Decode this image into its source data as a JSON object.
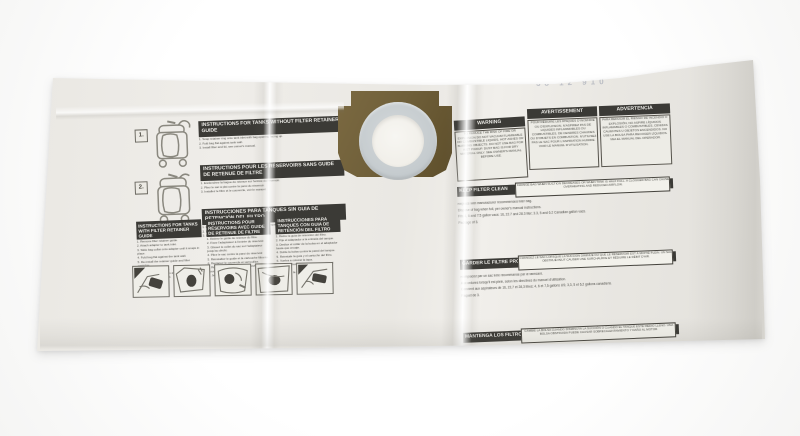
{
  "stamp": "38 12 910",
  "collar": {
    "color": "#70603a",
    "ring_color": "#c6cccf",
    "hole_color": "#f1efe9"
  },
  "left_panel": {
    "step1_label": "1.",
    "step2_label": "2.",
    "headers": [
      {
        "title": "INSTRUCTIONS FOR TANKS WITHOUT FILTER RETAINER GUIDE",
        "lines": [
          "1. Snap retainer ring onto tank inlet with bag opening facing up.",
          "2. Fold bag flat against tank wall.",
          "3. Install filter and lid, see owner's manual."
        ]
      },
      {
        "title": "INSTRUCTIONS POUR LES RÉSERVOIRS SANS GUIDE DE RETENUE DE FILTRE",
        "lines": [
          "1. Enclenchez la bague de retenue sur l'entrée du réservoir.",
          "2. Pliez le sac à plat contre la paroi du réservoir.",
          "3. Installez le filtre et le couvercle, voir le manuel."
        ]
      },
      {
        "title": "INSTRUCCIONES PARA TANQUES SIN GUIA DE RETENCIÓN DEL FILTRO",
        "lines": [
          "1. Encaje el anillo de retención en la entrada del tanque.",
          "2. Doble la bolsa plana contra la pared del tanque.",
          "3. Instale el filtro y la tapa, vea el manual."
        ]
      }
    ],
    "columns": [
      {
        "title": "INSTRUCTIONS FOR TANKS WITH FILTER RETAINER GUIDE",
        "lines": [
          "1. Remove filter retainer guide.",
          "2. Attach adapter to tank inlet.",
          "3. Slide bag collar onto adapter until it snaps in place.",
          "4. Fold bag flat against the tank wall.",
          "5. Re-install the retainer guide and filter cartridge.",
          "6. Replace lid and latch.",
          "7. Remove bag slowly to avoid dust.",
          "8. Discard bag when full."
        ]
      },
      {
        "title": "INSTRUCTIONS POUR RÉSERVOIRS AVEC GUIDE DE RETENUE DE FILTRE",
        "lines": [
          "1. Retirez le guide de retenue du filtre.",
          "2. Fixez l'adaptateur à l'entrée du réservoir.",
          "3. Glissez le collet du sac sur l'adaptateur jusqu'au déclic.",
          "4. Pliez le sac contre la paroi du réservoir.",
          "5. Réinstallez le guide et la cartouche filtrante.",
          "6. Replacez le couvercle et verrouillez.",
          "7. Retirez le sac lentement pour éviter la poussière.",
          "8. Jetez le sac lorsqu'il est plein."
        ]
      },
      {
        "title": "INSTRUCCIONES PARA TANQUES CON GUIA DE RETENCIÓN DEL FILTRO",
        "lines": [
          "1. Retire la guía de retención del filtro.",
          "2. Fije el adaptador a la entrada del tanque.",
          "3. Deslice el collar de la bolsa en el adaptador hasta que encaje.",
          "4. Doble la bolsa contra la pared del tanque.",
          "5. Reinstale la guía y el cartucho del filtro.",
          "6. Vuelva a colocar la tapa.",
          "7. Retire la bolsa lentamente para evitar el polvo.",
          "8. Deseche la bolsa cuando esté llena."
        ]
      }
    ],
    "pictograms": [
      "insert-bag",
      "position-collar",
      "press-collar",
      "fold-bag",
      "replace-lid"
    ]
  },
  "right_panel": {
    "warnings": [
      {
        "title": "WARNING",
        "body": "TO REDUCE THE RISK OF FIRE OR EXPLOSION DO NOT VACUUM FLAMMABLE OR COMBUSTIBLE LIQUIDS, HOT ASHES OR BURNING OBJECTS. DO NOT USE BAG FOR WET PICKUP. DUST BAG IS FOR DRY MATERIAL ONLY. SEE OWNER'S MANUAL BEFORE USE."
      },
      {
        "title": "AVERTISSEMENT",
        "body": "POUR RÉDUIRE LES RISQUES D'INCENDIE OU D'EXPLOSION, N'ASPIREZ PAS DE LIQUIDES INFLAMMABLES OU COMBUSTIBLES, DE CENDRES CHAUDES OU D'OBJETS EN COMBUSTION. N'UTILISEZ PAS LE SAC POUR L'ASPIRATION HUMIDE. VOIR LE MANUEL D'UTILISATION."
      },
      {
        "title": "ADVERTENCIA",
        "body": "PARA REDUCIR EL RIESGO DE INCENDIO O EXPLOSIÓN, NO ASPIRE LÍQUIDOS INFLAMABLES O COMBUSTIBLES, CENIZAS CALIENTES U OBJETOS ENCENDIDOS. NO USE LA BOLSA PARA RECOGER LÍQUIDOS. VEA EL MANUAL DEL OPERADOR."
      }
    ],
    "sections": [
      {
        "bar": "KEEP FILTER CLEAN",
        "note": "CHANGE BAG WHEN SUCTION DECREASES OR WHEN TANK IS HALF FULL. A CLOGGED BAG CAN CAUSE OVERHEATING AND REDUCED AIRFLOW.",
        "lines": [
          "Replace with manufacturer recommended filter bag.",
          "Dispose of bag when full, per owner's manual instructions.",
          "Fits 4, 6 and 7.5 gallon vacs: 16, 22.7 and 28.3 liter; 3.3, 5 and 6.2 Canadian gallon vacs.",
          "Package of 3."
        ]
      },
      {
        "bar": "GARDER LE FILTRE PROPRE",
        "note": "CHANGEZ LE SAC LORSQUE LA SUCCION DIMINUE OU QUE LE RÉSERVOIR EST À MOITIÉ PLEIN. UN SAC OBSTRUÉ PEUT CAUSER UNE SURCHAUFFE ET RÉDUIRE LE DÉBIT D'AIR.",
        "lines": [
          "Remplacez par un sac filtre recommandé par le fabricant.",
          "Aux ordures lorsqu'il est plein, selon les directives du manuel d'utilisation.",
          "Convient aux aspirateurs de 16, 22,7 et 28,3 litres; 4, 6 et 7,5 gallons US; 3,3, 5 et 6,2 gallons canadiens.",
          "Paquet de 3."
        ]
      },
      {
        "bar": "MANTENGA LOS FILTROS LIMPIOS",
        "note": "CAMBIE LA BOLSA CUANDO DISMINUYA LA SUCCIÓN O CUANDO EL TANQUE ESTÉ MEDIO LLENO. UNA BOLSA OBSTRUIDA PUEDE CAUSAR SOBRECALENTAMIENTO Y DAÑO AL MOTOR.",
        "lines": [
          "Reemplace con una bolsa de filtro recomendada por los fabricantes.",
          "Deséchela al estar llena, consulte el manual del operador para el manejo seguro de los desechos.",
          "Se adapta a las aspiradoras de 16, 22.5 y 28.3 litros; 4, 6 y 7.5 galones; hidroaspiradoras.",
          "Paquete de 3."
        ]
      }
    ]
  }
}
